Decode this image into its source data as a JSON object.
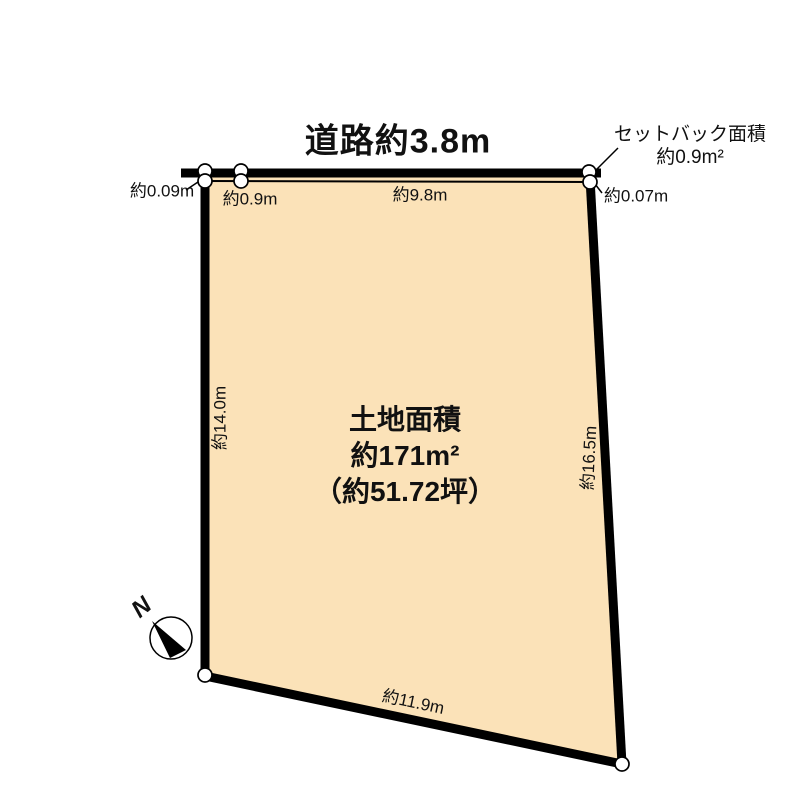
{
  "diagram": {
    "road": {
      "label": "道路約3.8m"
    },
    "setback": {
      "title": "セットバック面積",
      "area": "約0.9m²"
    },
    "dimensions": {
      "offset_top_left": "約0.09m",
      "frontage_left": "約0.9m",
      "frontage_main": "約9.8m",
      "offset_top_right": "約0.07m",
      "side_left": "約14.0m",
      "side_right": "約16.5m",
      "side_bottom": "約11.9m"
    },
    "land_area": {
      "title": "土地面積",
      "area_sqm": "約171m²",
      "area_tsubo": "（約51.72坪）"
    },
    "compass": {
      "north_label": "N"
    },
    "colors": {
      "plot_fill": "#fbe2b8",
      "line_color": "#000000",
      "background": "#ffffff"
    }
  }
}
